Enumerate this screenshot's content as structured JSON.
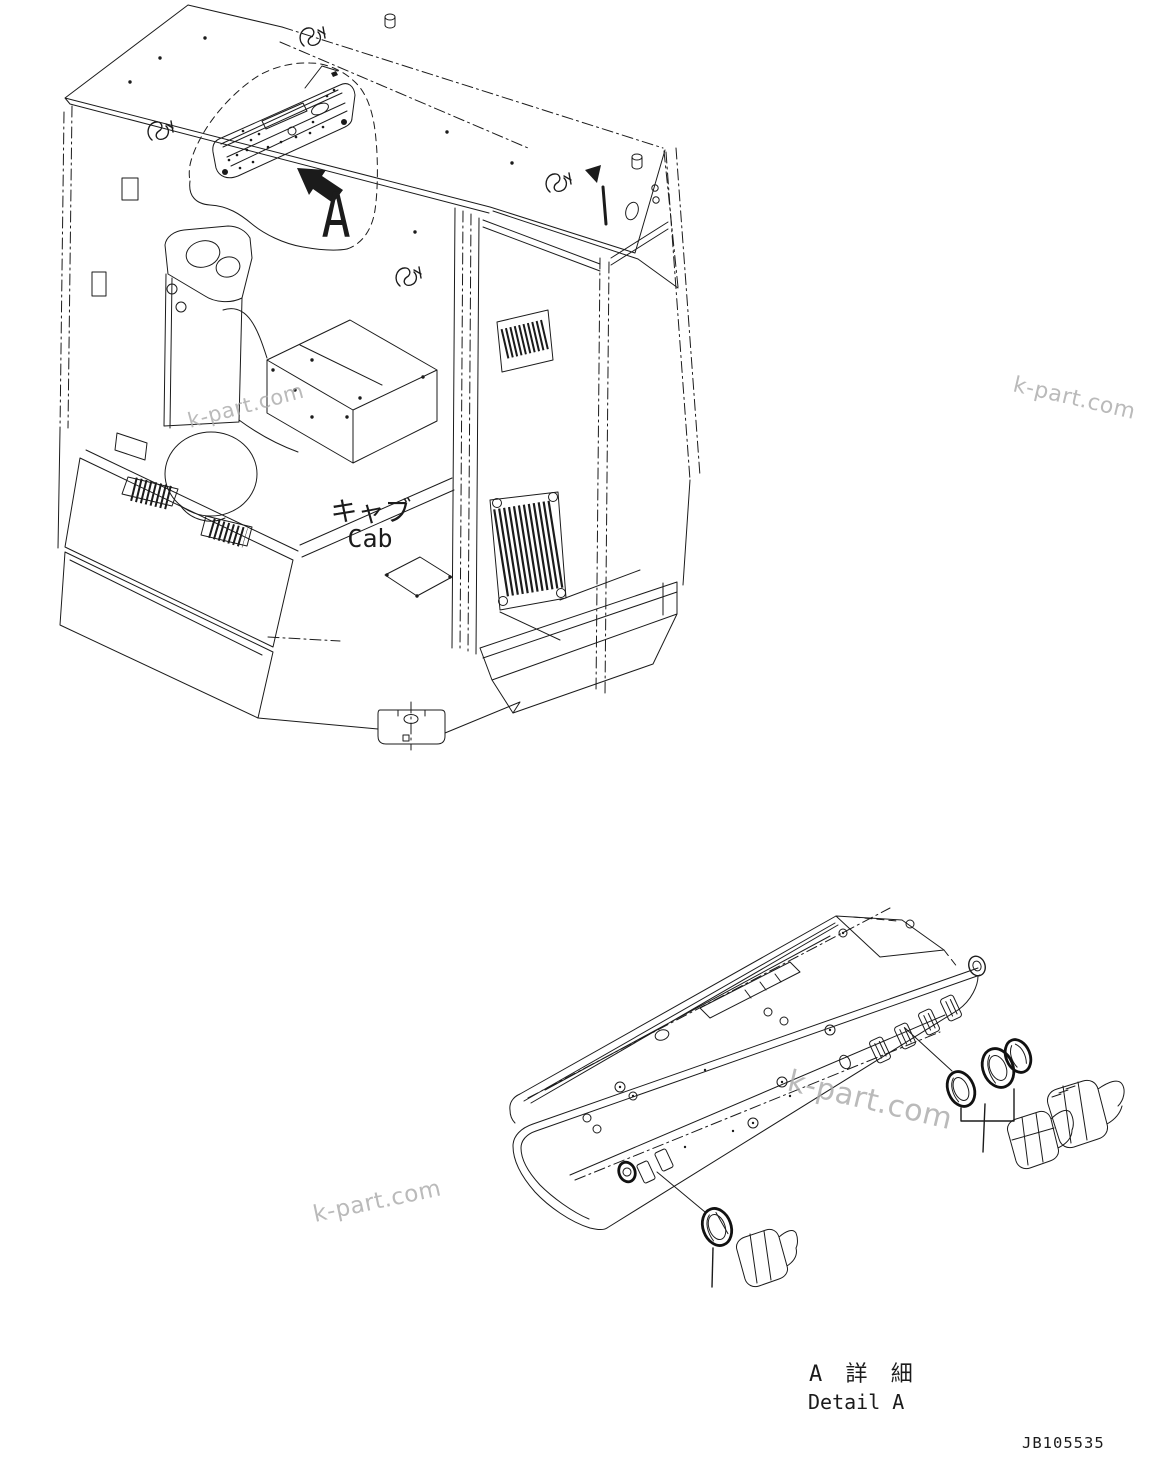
{
  "figure": {
    "type": "exploded-parts-diagram",
    "colors": {
      "line": "#1b1b1b",
      "background": "#ffffff",
      "watermark": "#a9a9a9"
    },
    "cab_view": {
      "label_ja": "キャブ",
      "label_en": "Cab",
      "callout_letter": "A"
    },
    "detail_view": {
      "label_ja": "A 詳 細",
      "label_en": "Detail A"
    },
    "drawing_number": "JB105535",
    "watermark_text": "k-part.com"
  }
}
